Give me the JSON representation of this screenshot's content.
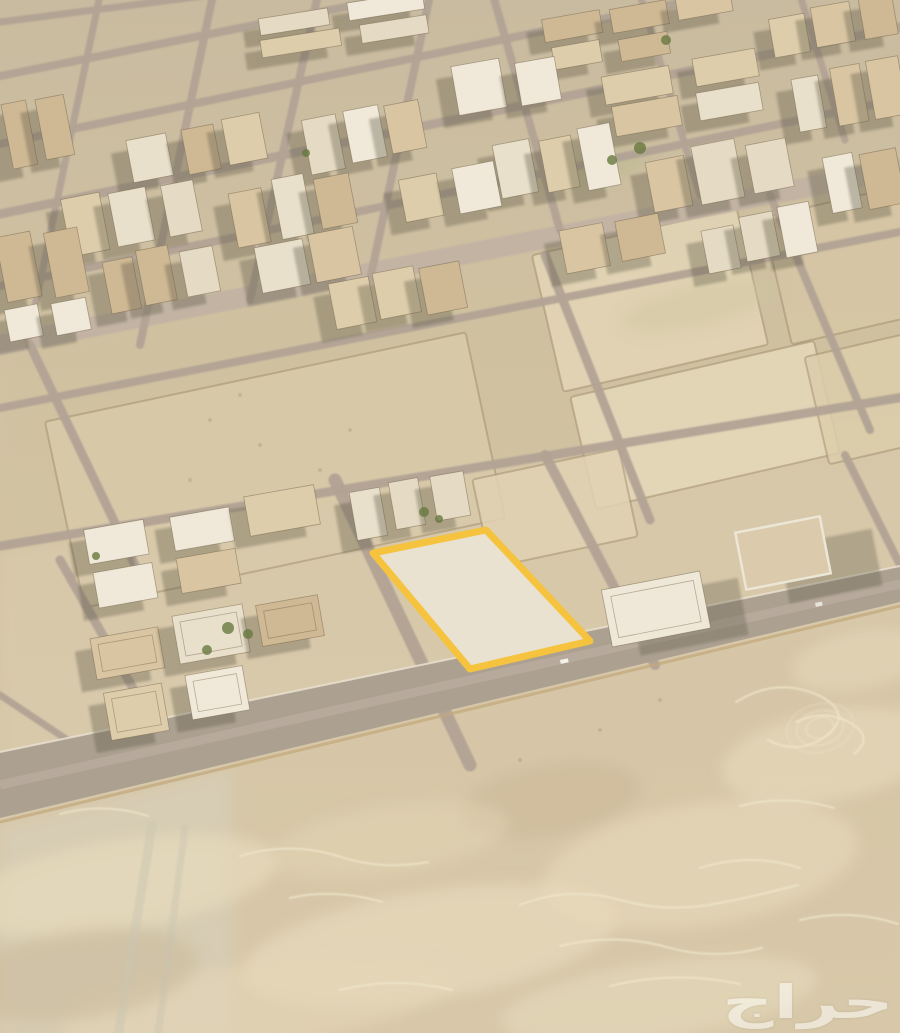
{
  "meta": {
    "width": 900,
    "height": 1033,
    "view": "satellite-oblique"
  },
  "watermark": {
    "text": "حراج",
    "color": "#fbfaf5",
    "opacity": 0.58
  },
  "palette": {
    "sand_top": "#c9bb9f",
    "sand_mid": "#d2c2a3",
    "sand_low": "#d7c7a8",
    "road": "#b2a395",
    "avenue": "#c1b3a4",
    "big_road": "#aca091",
    "shadow": "#5e5a46",
    "tree": "#68793f",
    "plot_stroke": "#f6c33e",
    "plot_fill": "#eae2d1",
    "building_fills": [
      "#f0e9d9",
      "#e9e0cb",
      "#decdab",
      "#e5dac3",
      "#d9c5a2",
      "#cfb894"
    ]
  },
  "scene": {
    "tints": [
      {
        "pts": [
          [
            0,
            350
          ],
          [
            910,
            174
          ],
          [
            910,
            402
          ],
          [
            0,
            552
          ]
        ],
        "fill": "#cdbf9f",
        "op": 0.35
      },
      {
        "pts": [
          [
            0,
            552
          ],
          [
            910,
            402
          ],
          [
            910,
            612
          ],
          [
            0,
            786
          ]
        ],
        "fill": "#dccdaf",
        "op": 0.5
      },
      {
        "pts": [
          [
            0,
            788
          ],
          [
            910,
            614
          ],
          [
            910,
            1035
          ],
          [
            0,
            1035
          ]
        ],
        "fill": "#d8c7a7",
        "op": 0.4
      },
      {
        "pts": [
          [
            0,
            828
          ],
          [
            230,
            770
          ],
          [
            230,
            1035
          ],
          [
            0,
            1035
          ]
        ],
        "fill": "#d8d2c0",
        "op": 0.55
      }
    ],
    "lots": [
      {
        "cx": 275,
        "cy": 470,
        "w": 430,
        "h": 190,
        "rot": -12,
        "fill": "#d9caaa"
      },
      {
        "cx": 650,
        "cy": 300,
        "w": 210,
        "h": 140,
        "rot": -13,
        "fill": "#e3d6b6"
      },
      {
        "cx": 860,
        "cy": 262,
        "w": 170,
        "h": 130,
        "rot": -13,
        "fill": "#d7c7a5"
      },
      {
        "cx": 705,
        "cy": 425,
        "w": 250,
        "h": 115,
        "rot": -13,
        "fill": "#e6d9ba"
      },
      {
        "cx": 885,
        "cy": 395,
        "w": 140,
        "h": 110,
        "rot": -13,
        "fill": "#dccdab"
      },
      {
        "cx": 555,
        "cy": 508,
        "w": 150,
        "h": 90,
        "rot": -12,
        "fill": "#e0d2b2"
      }
    ],
    "patches": [
      [
        120,
        885,
        160,
        45,
        -9,
        "#e8dbbd",
        0.65
      ],
      [
        430,
        945,
        190,
        55,
        -9,
        "#e9dcbe",
        0.6
      ],
      [
        700,
        865,
        160,
        62,
        -9,
        "#e7d9ba",
        0.6
      ],
      [
        260,
        1005,
        200,
        42,
        -8,
        "#e5d7b8",
        0.55
      ],
      [
        660,
        1000,
        160,
        38,
        -8,
        "#eaddc0",
        0.5
      ],
      [
        830,
        755,
        110,
        45,
        -10,
        "#e8dabc",
        0.6
      ],
      [
        550,
        800,
        90,
        35,
        -10,
        "#c9b695",
        0.5
      ],
      [
        80,
        975,
        120,
        45,
        -8,
        "#c8b695",
        0.45
      ],
      [
        390,
        840,
        120,
        35,
        -9,
        "#e3d5b6",
        0.5
      ],
      [
        860,
        660,
        70,
        30,
        -11,
        "#e6d8ba",
        0.55
      ],
      [
        590,
        168,
        60,
        16,
        -12,
        "#b9b98e",
        0.5
      ],
      [
        700,
        305,
        80,
        20,
        -13,
        "#cfc6a0",
        0.45
      ]
    ],
    "swirls": [
      "M736 702 q42 -26 84 -6 q34 18 6 40 q-28 20 -58 4",
      "M796 722 q30 -14 56 2 q22 14 2 30",
      "M520 905 q50 -20 104 -4 q46 12 96 2 q40 -8 78 -18",
      "M560 946 q54 -14 110 2 q44 12 92 0",
      "M610 986 q64 -16 130 -2",
      "M700 868 q50 -16 100 0",
      "M240 856 q52 -16 104 2 q40 12 84 4",
      "M290 898 q44 -10 92 4",
      "M60 814 q44 -12 88 2",
      "M740 806 q46 -12 94 2",
      "M800 920 q50 -12 98 4",
      "M340 990 q56 -14 112 0"
    ],
    "rings": [
      [
        820,
        728,
        14,
        10,
        -15,
        0.5
      ],
      [
        820,
        728,
        24,
        17,
        -15,
        0.4
      ],
      [
        820,
        728,
        34,
        24,
        -15,
        0.32
      ]
    ],
    "roads": [
      [
        0,
        22,
        235,
        -8,
        7
      ],
      [
        0,
        76,
        520,
        -28,
        8
      ],
      [
        0,
        144,
        770,
        -16,
        8
      ],
      [
        0,
        214,
        910,
        25,
        9
      ],
      [
        0,
        286,
        910,
        97,
        8
      ],
      [
        0,
        345,
        910,
        167,
        20,
        "#c1b3a4",
        0.95
      ],
      [
        0,
        408,
        910,
        230,
        8
      ],
      [
        0,
        546,
        910,
        396,
        9
      ],
      [
        100,
        -5,
        28,
        340,
        7
      ],
      [
        213,
        -5,
        140,
        345,
        8
      ],
      [
        318,
        -5,
        250,
        300,
        8
      ],
      [
        430,
        -5,
        370,
        280,
        8
      ],
      [
        493,
        -5,
        560,
        230,
        8
      ],
      [
        640,
        -5,
        700,
        195,
        7
      ],
      [
        800,
        -5,
        845,
        140,
        7
      ],
      [
        30,
        345,
        135,
        565,
        9
      ],
      [
        545,
        255,
        650,
        520,
        9
      ],
      [
        770,
        195,
        870,
        430,
        8
      ],
      [
        60,
        560,
        175,
        762,
        9
      ],
      [
        335,
        480,
        470,
        765,
        13
      ],
      [
        545,
        455,
        655,
        665,
        10
      ],
      [
        845,
        455,
        905,
        575,
        8
      ],
      [
        0,
        695,
        75,
        745,
        7
      ],
      [
        152,
        826,
        118,
        1035,
        9,
        "#ccc5b2",
        0.5
      ],
      [
        185,
        828,
        158,
        1035,
        7,
        "#c9c2af",
        0.4
      ]
    ],
    "big_road": {
      "pts": [
        [
          0,
          752
        ],
        [
          900,
          566
        ],
        [
          900,
          602
        ],
        [
          0,
          818
        ]
      ],
      "fill": "#aca091",
      "stripes": [
        [
          0,
          785,
          900,
          584,
          9,
          "#b9aca0",
          0.85
        ],
        [
          0,
          752,
          900,
          566,
          2,
          "#e9e1d0",
          0.85
        ],
        [
          0,
          822,
          900,
          606,
          3,
          "#c3a97d",
          0.75
        ]
      ]
    },
    "plot": {
      "points": [
        [
          373,
          553
        ],
        [
          486,
          530
        ],
        [
          590,
          641
        ],
        [
          470,
          669
        ]
      ],
      "stroke": "#f6c33e",
      "stroke_width": 7,
      "fill": "#eae2d1"
    },
    "blocks": [
      [
        540,
        2,
        200,
        58,
        -10,
        5,
        1
      ],
      [
        766,
        0,
        134,
        52,
        -10,
        3,
        2
      ],
      [
        248,
        0,
        190,
        48,
        -9,
        4,
        3
      ],
      [
        452,
        55,
        112,
        58,
        -10,
        2,
        4
      ],
      [
        598,
        58,
        172,
        70,
        -10,
        4,
        5
      ],
      [
        792,
        62,
        112,
        70,
        -10,
        3,
        6
      ],
      [
        128,
        118,
        142,
        60,
        -11,
        3,
        7
      ],
      [
        298,
        103,
        132,
        64,
        -11,
        3,
        8
      ],
      [
        0,
        92,
        70,
        80,
        -11,
        2,
        9
      ],
      [
        492,
        128,
        132,
        70,
        -11,
        3,
        10
      ],
      [
        642,
        138,
        152,
        70,
        -11,
        3,
        11
      ],
      [
        818,
        148,
        86,
        64,
        -11,
        2,
        12
      ],
      [
        62,
        183,
        142,
        70,
        -11,
        3,
        13
      ],
      [
        228,
        173,
        132,
        70,
        -11,
        3,
        14
      ],
      [
        392,
        163,
        112,
        58,
        -11,
        2,
        15
      ],
      [
        0,
        228,
        86,
        74,
        -11,
        2,
        16
      ],
      [
        98,
        246,
        122,
        62,
        -11,
        3,
        17
      ],
      [
        252,
        233,
        112,
        58,
        -11,
        2,
        18
      ],
      [
        698,
        210,
        122,
        58,
        -11,
        3,
        19
      ],
      [
        0,
        298,
        92,
        46,
        -11,
        2,
        20
      ],
      [
        328,
        268,
        142,
        54,
        -11,
        3,
        21
      ],
      [
        556,
        213,
        112,
        54,
        -11,
        2,
        22
      ],
      [
        78,
        503,
        252,
        92,
        -10,
        5,
        23
      ],
      [
        92,
        608,
        244,
        116,
        -10,
        5,
        24
      ],
      [
        350,
        476,
        118,
        56,
        -10,
        3,
        25
      ]
    ],
    "singles": [
      {
        "x": 606,
        "y": 580,
        "w": 100,
        "h": 58,
        "rot": -11,
        "fill": "#efe8d8",
        "shadow": [
          26,
          14
        ]
      },
      {
        "x": 740,
        "y": 524,
        "w": 86,
        "h": 58,
        "rot": -11,
        "wall": true,
        "fill": "#dbcbac",
        "shadow": [
          40,
          22
        ]
      }
    ],
    "shadow_default": [
      -17,
      10
    ],
    "trees": [
      [
        640,
        148,
        6
      ],
      [
        666,
        40,
        5
      ],
      [
        424,
        512,
        5
      ],
      [
        439,
        519,
        4
      ],
      [
        228,
        628,
        6
      ],
      [
        248,
        634,
        5
      ],
      [
        207,
        650,
        5
      ],
      [
        96,
        556,
        4
      ],
      [
        306,
        153,
        4
      ],
      [
        612,
        160,
        5
      ]
    ],
    "dots": [
      [
        210,
        420
      ],
      [
        260,
        445
      ],
      [
        320,
        470
      ],
      [
        190,
        480
      ],
      [
        280,
        500
      ],
      [
        350,
        430
      ],
      [
        240,
        395
      ],
      [
        300,
        520
      ],
      [
        520,
        760
      ],
      [
        600,
        730
      ],
      [
        660,
        700
      ]
    ],
    "cars": [
      {
        "x": 560,
        "y": 660,
        "w": 8,
        "h": 4,
        "rot": -12,
        "fill": "#f5f2ea"
      },
      {
        "x": 815,
        "y": 603,
        "w": 7,
        "h": 4,
        "rot": -12,
        "fill": "#e8e4da"
      }
    ]
  }
}
